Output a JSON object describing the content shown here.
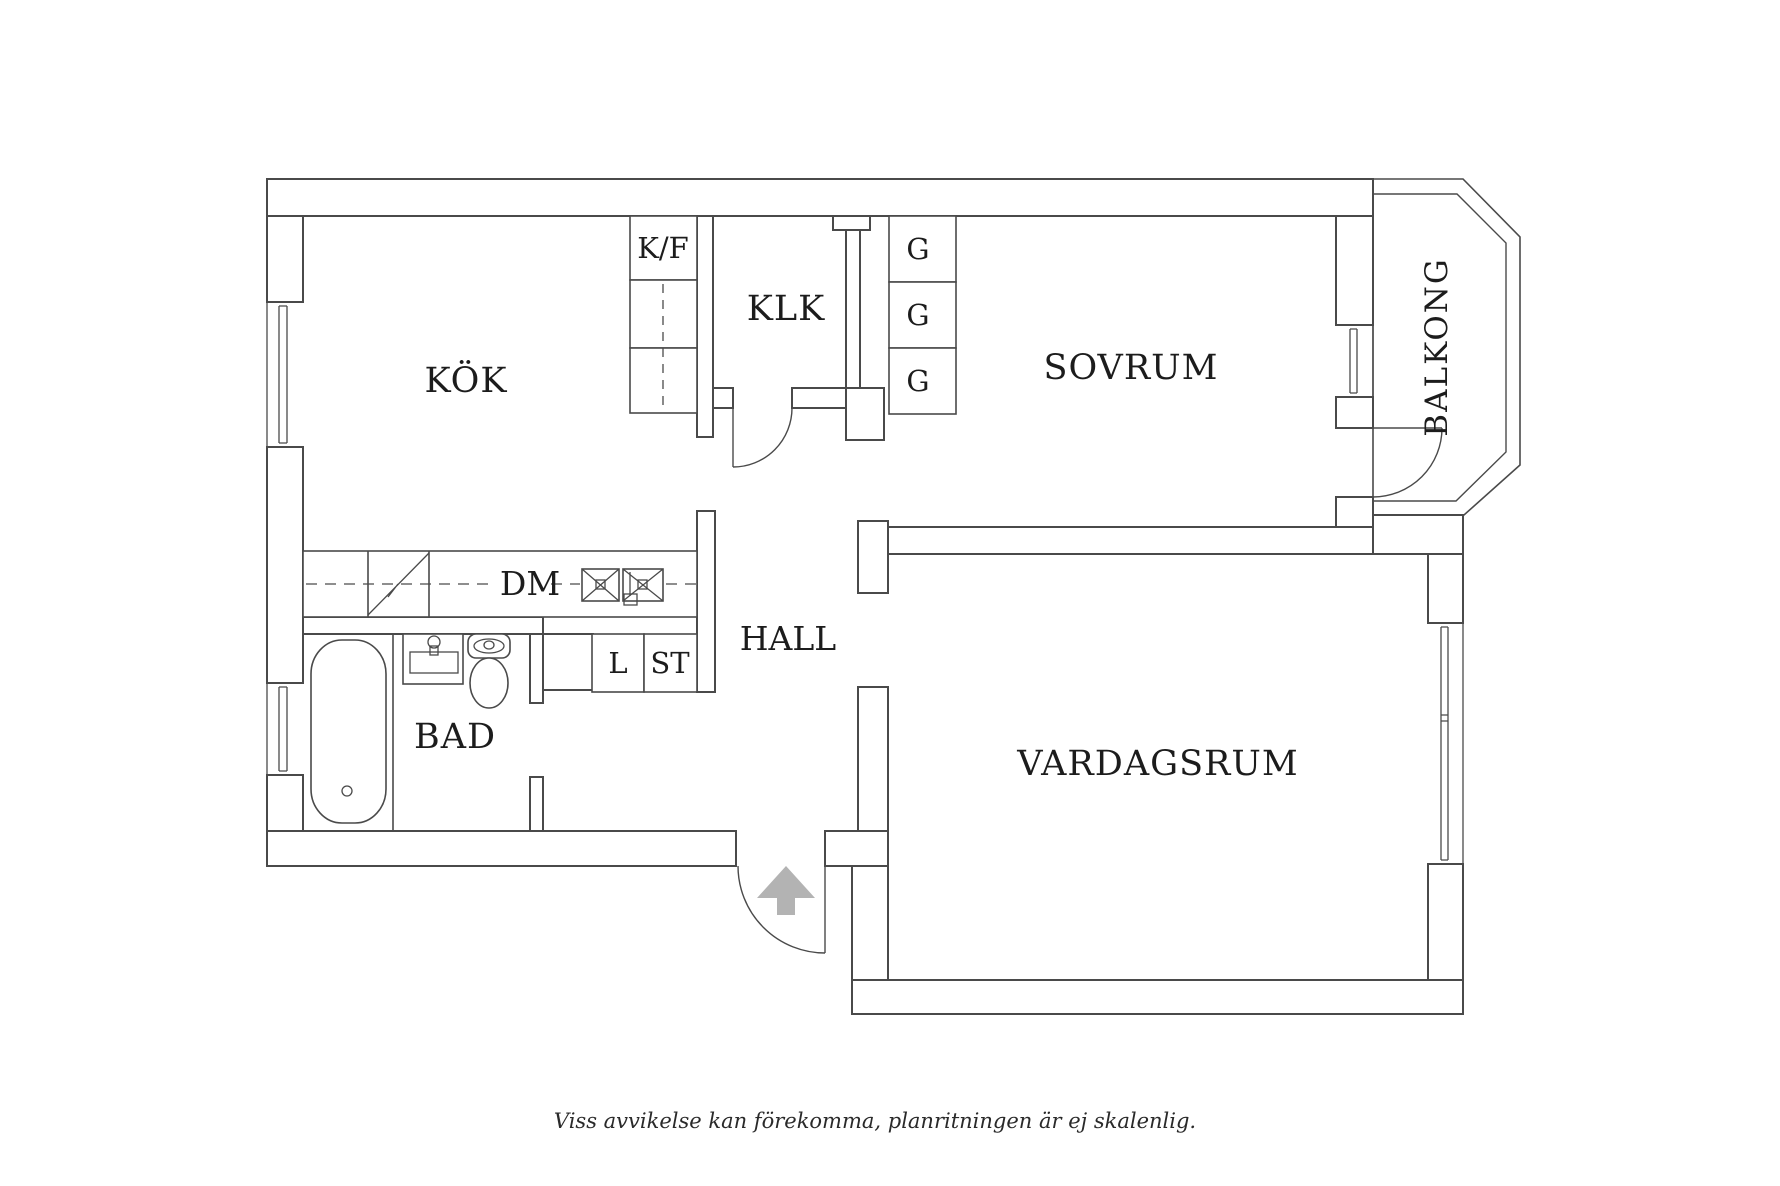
{
  "colors": {
    "background": "#ffffff",
    "wall_line": "#4a4a4a",
    "text": "#1c1c1c",
    "entrance_arrow": "#b3b3b3"
  },
  "floorplan": {
    "rooms": [
      {
        "id": "kitchen",
        "label": "KÖK"
      },
      {
        "id": "walk_in_closet",
        "label": "KLK"
      },
      {
        "id": "bedroom",
        "label": "SOVRUM"
      },
      {
        "id": "balcony",
        "label": "BALKONG"
      },
      {
        "id": "hall",
        "label": "HALL"
      },
      {
        "id": "bathroom",
        "label": "BAD"
      },
      {
        "id": "living_room",
        "label": "VARDAGSRUM"
      }
    ],
    "fixture_labels": {
      "fridge_freezer": "K/F",
      "wardrobes": [
        "G",
        "G",
        "G"
      ],
      "dishwasher": "DM",
      "linen_cabinet": "L",
      "storage_cabinet": "ST"
    }
  },
  "footer": {
    "disclaimer": "Viss avvikelse kan förekomma, planritningen är ej skalenlig."
  }
}
